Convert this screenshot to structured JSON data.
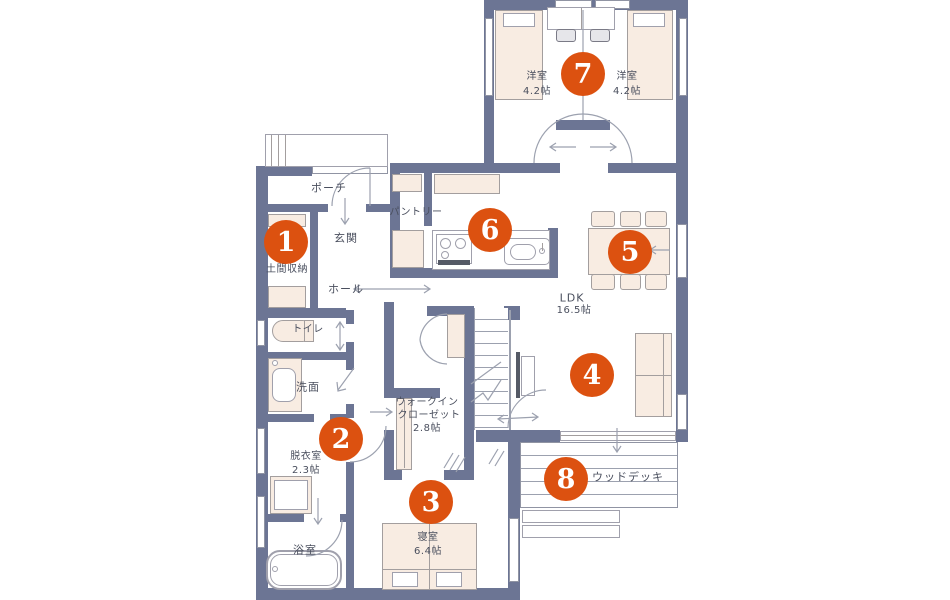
{
  "colors": {
    "wall": "#6C7594",
    "furniture_fill": "#F8ECE2",
    "line": "#9CA1AF",
    "marker": "#DC5110",
    "marker_text": "#FFFFFF",
    "text": "#4A4F5E"
  },
  "markers": [
    "1",
    "2",
    "3",
    "4",
    "5",
    "6",
    "7",
    "8"
  ],
  "rooms": {
    "porch": "ポーチ",
    "pantry": "パントリー",
    "entrance": "玄関",
    "doma_storage": "土間収納",
    "hall": "ホール",
    "toilet": "トイレ",
    "washroom": "洗面",
    "dressing_name": "脱衣室",
    "dressing_size": "2.3帖",
    "bath": "浴室",
    "wic_line1": "ウォークイン",
    "wic_line2": "クローゼット",
    "wic_size": "2.8帖",
    "bedroom_name": "寝室",
    "bedroom_size": "6.4帖",
    "ldk_name": "LDK",
    "ldk_size": "16.5帖",
    "western_left_name": "洋室",
    "western_left_size": "4.2帖",
    "western_right_name": "洋室",
    "western_right_size": "4.2帖",
    "wood_deck": "ウッドデッキ"
  }
}
